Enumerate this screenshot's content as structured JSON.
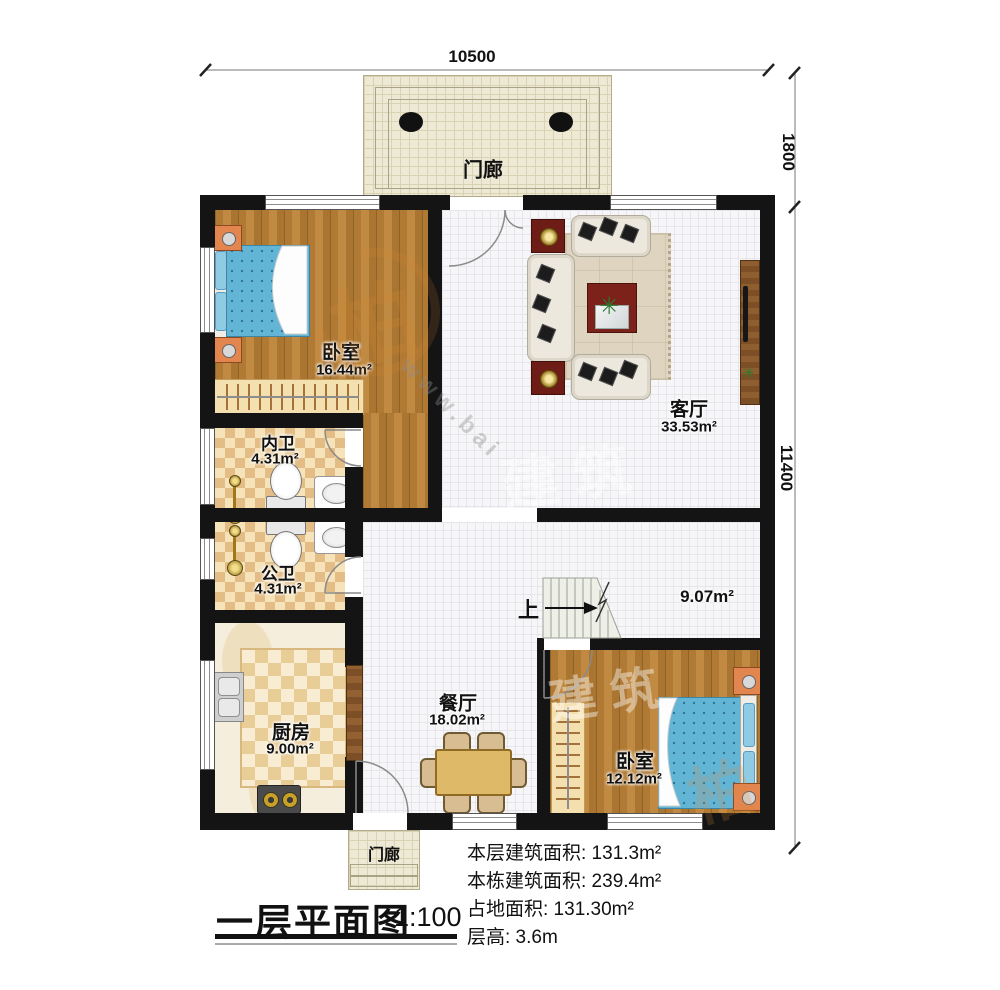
{
  "meta": {
    "drawing_type": "floor-plan",
    "colors": {
      "wall": "#141414",
      "wood_floor": "#b07a35",
      "tile_floor": "#f6f6f8",
      "bath_checker": "#e3bd85",
      "porch_fill": "#eee9d5",
      "bed_blue": "#63b5d6",
      "accent_red": "#7d211b",
      "table_tan": "#ddb968"
    }
  },
  "dimensions": {
    "top_width": "10500",
    "right_upper": "1800",
    "right_lower": "11400"
  },
  "rooms": {
    "porch_top": {
      "name": "门廊"
    },
    "bedroom1": {
      "name": "卧室",
      "area": "16.44m²"
    },
    "living": {
      "name": "客厅",
      "area": "33.53m²"
    },
    "bath_inner": {
      "name": "内卫",
      "area": "4.31m²"
    },
    "bath_public": {
      "name": "公卫",
      "area": "4.31m²"
    },
    "kitchen": {
      "name": "厨房",
      "area": "9.00m²"
    },
    "dining": {
      "name": "餐厅",
      "area": "18.02m²"
    },
    "hall": {
      "area": "9.07m²"
    },
    "bedroom2": {
      "name": "卧室",
      "area": "12.12m²"
    },
    "porch_bottom": {
      "name": "门廊"
    }
  },
  "stairs": {
    "up_label": "上"
  },
  "title": {
    "text": "一层平面图",
    "scale": "1:100"
  },
  "info": {
    "lines": [
      "本层建筑面积: 131.3m²",
      "本栋建筑面积: 239.4m²",
      "占地面积: 131.30m²",
      "层高: 3.6m"
    ]
  },
  "watermark": {
    "logo_char": "柏",
    "brand": "建筑",
    "url": "www.bai"
  }
}
